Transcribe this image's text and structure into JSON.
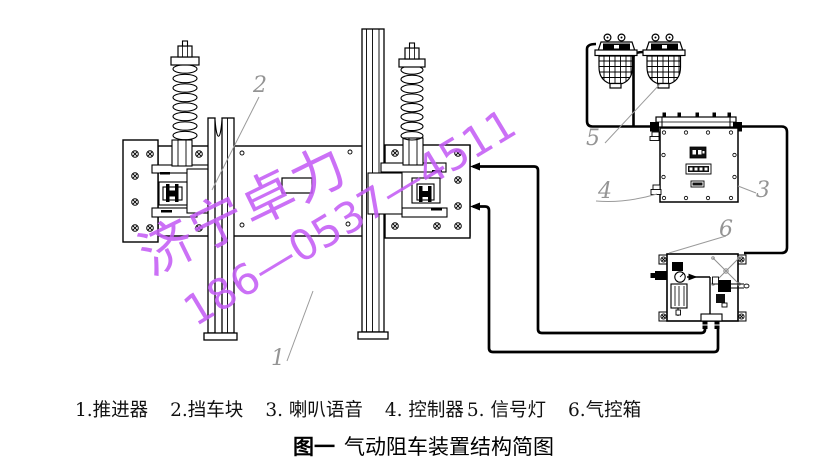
{
  "watermark": {
    "line1": "济宁卓力",
    "line2": "186—0537—4511",
    "color": "#c45df5"
  },
  "callouts": [
    "1",
    "2",
    "3",
    "4",
    "5",
    "6"
  ],
  "legend": {
    "items": [
      "1.推进器",
      "2.挡车块",
      "3. 喇叭语音",
      "4. 控制器",
      "5. 信号灯",
      "6.气控箱"
    ]
  },
  "figure_caption": {
    "label": "图一",
    "title": "气动阻车装置结构简图"
  },
  "colors": {
    "line": "#000000",
    "leader": "#9a9a9a",
    "watermark": "#c45df5",
    "background": "#ffffff"
  }
}
